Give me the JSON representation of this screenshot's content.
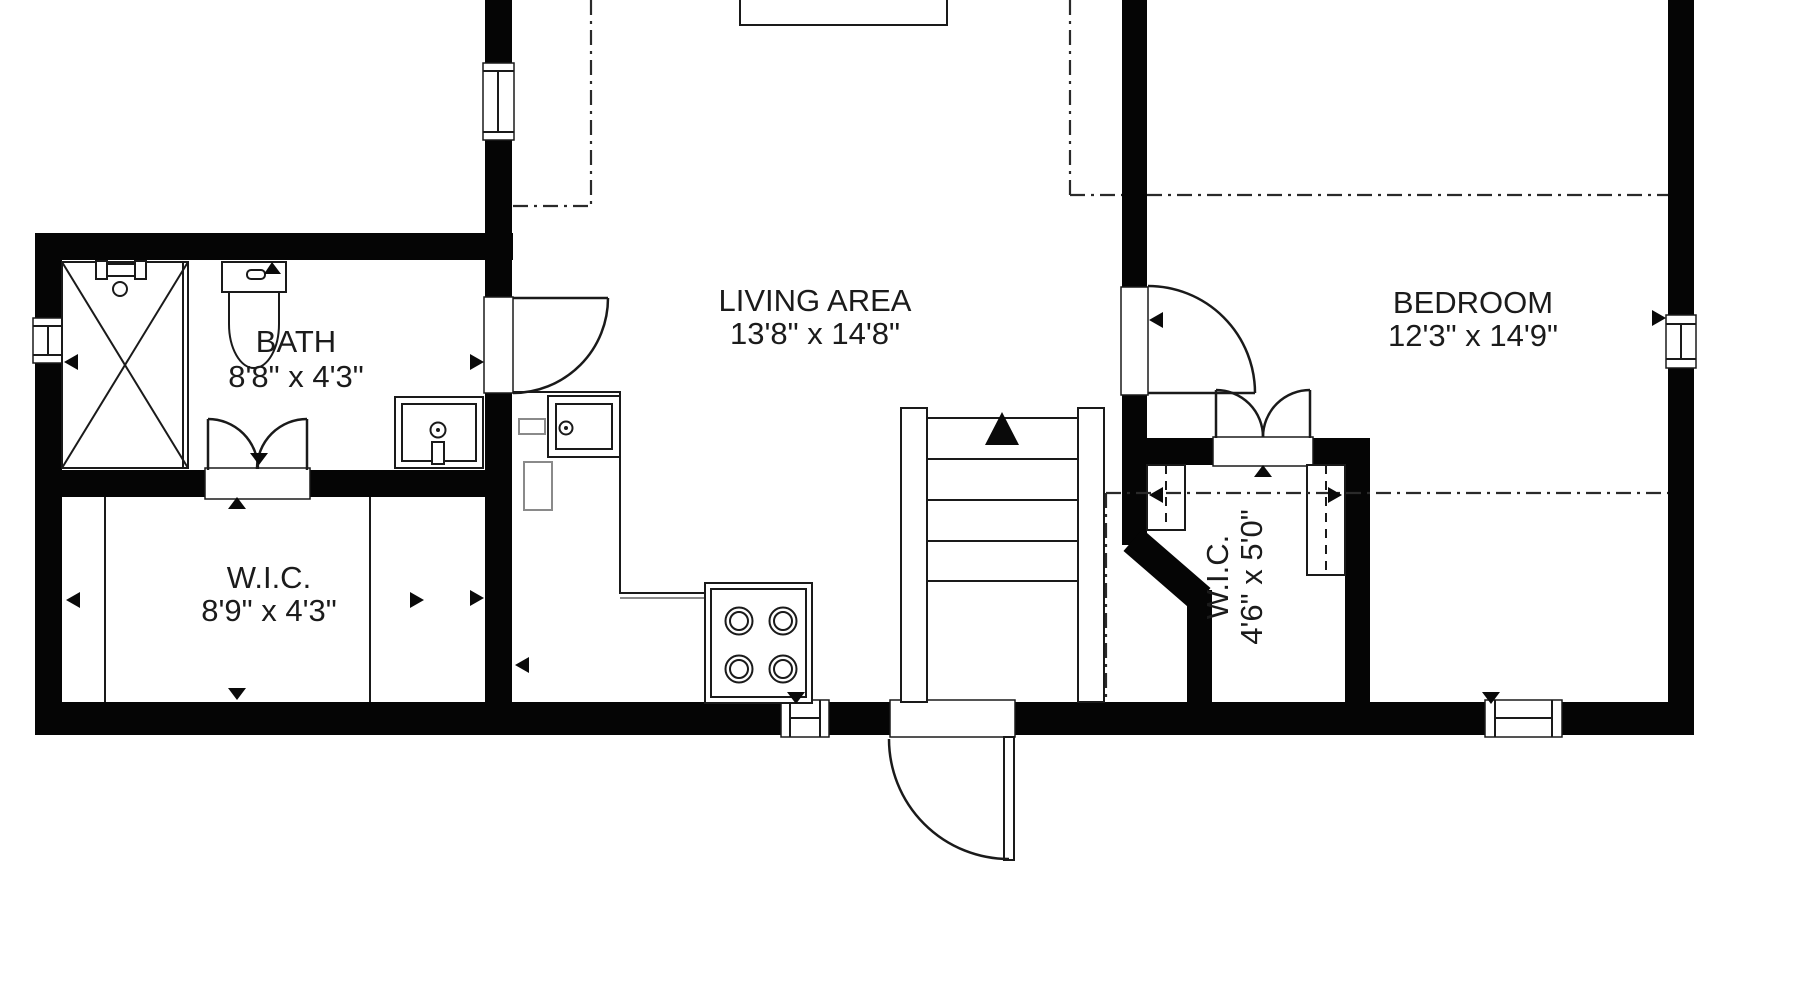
{
  "plan": {
    "title": "apartment floor plan",
    "rooms": [
      {
        "name": "LIVING AREA",
        "dimensions": "13'8\" x 14'8\""
      },
      {
        "name": "BEDROOM",
        "dimensions": "12'3\" x 14'9\""
      },
      {
        "name": "BATH",
        "dimensions": "8'8\" x 4'3\""
      },
      {
        "name": "W.I.C.",
        "dimensions": "8'9\" x 4'3\""
      },
      {
        "name": "W.I.C.",
        "dimensions": "4'6\" x 5'0\""
      }
    ],
    "features": {
      "stairs_direction": "up",
      "fixtures": [
        "shower",
        "toilet",
        "bath-sink",
        "kitchen-sink",
        "stove",
        "kitchen-island",
        "kitchen-counter",
        "closet-rods"
      ]
    },
    "colors": {
      "wall": "#050505",
      "background": "#ffffff",
      "text": "#1b1b1b"
    }
  }
}
